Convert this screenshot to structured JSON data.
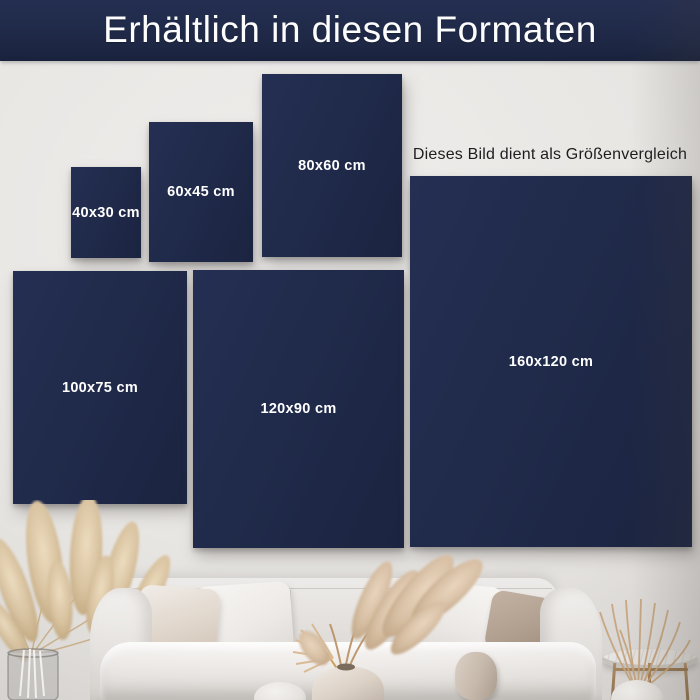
{
  "header": {
    "title": "Erhältlich in diesen Formaten"
  },
  "note": {
    "text": "Dieses Bild dient als Größenvergleich"
  },
  "formats": [
    {
      "label": "40x30 cm"
    },
    {
      "label": "60x45 cm"
    },
    {
      "label": "80x60 cm"
    },
    {
      "label": "100x75 cm"
    },
    {
      "label": "120x90 cm"
    },
    {
      "label": "160x120 cm"
    }
  ],
  "colors": {
    "header_bg": "#1e2845",
    "canvas_bg": "#202a4a",
    "canvas_text": "#ffffff",
    "note_text": "#1d1d1f",
    "wall": "#e7e5e2",
    "table_bronze": "#9f7f58",
    "pampas_tan": "#d6c0a0"
  },
  "scene": {
    "items": "pampas-grass, glass-vase, sofa, pillows, vases, dried-grass, side-table"
  }
}
